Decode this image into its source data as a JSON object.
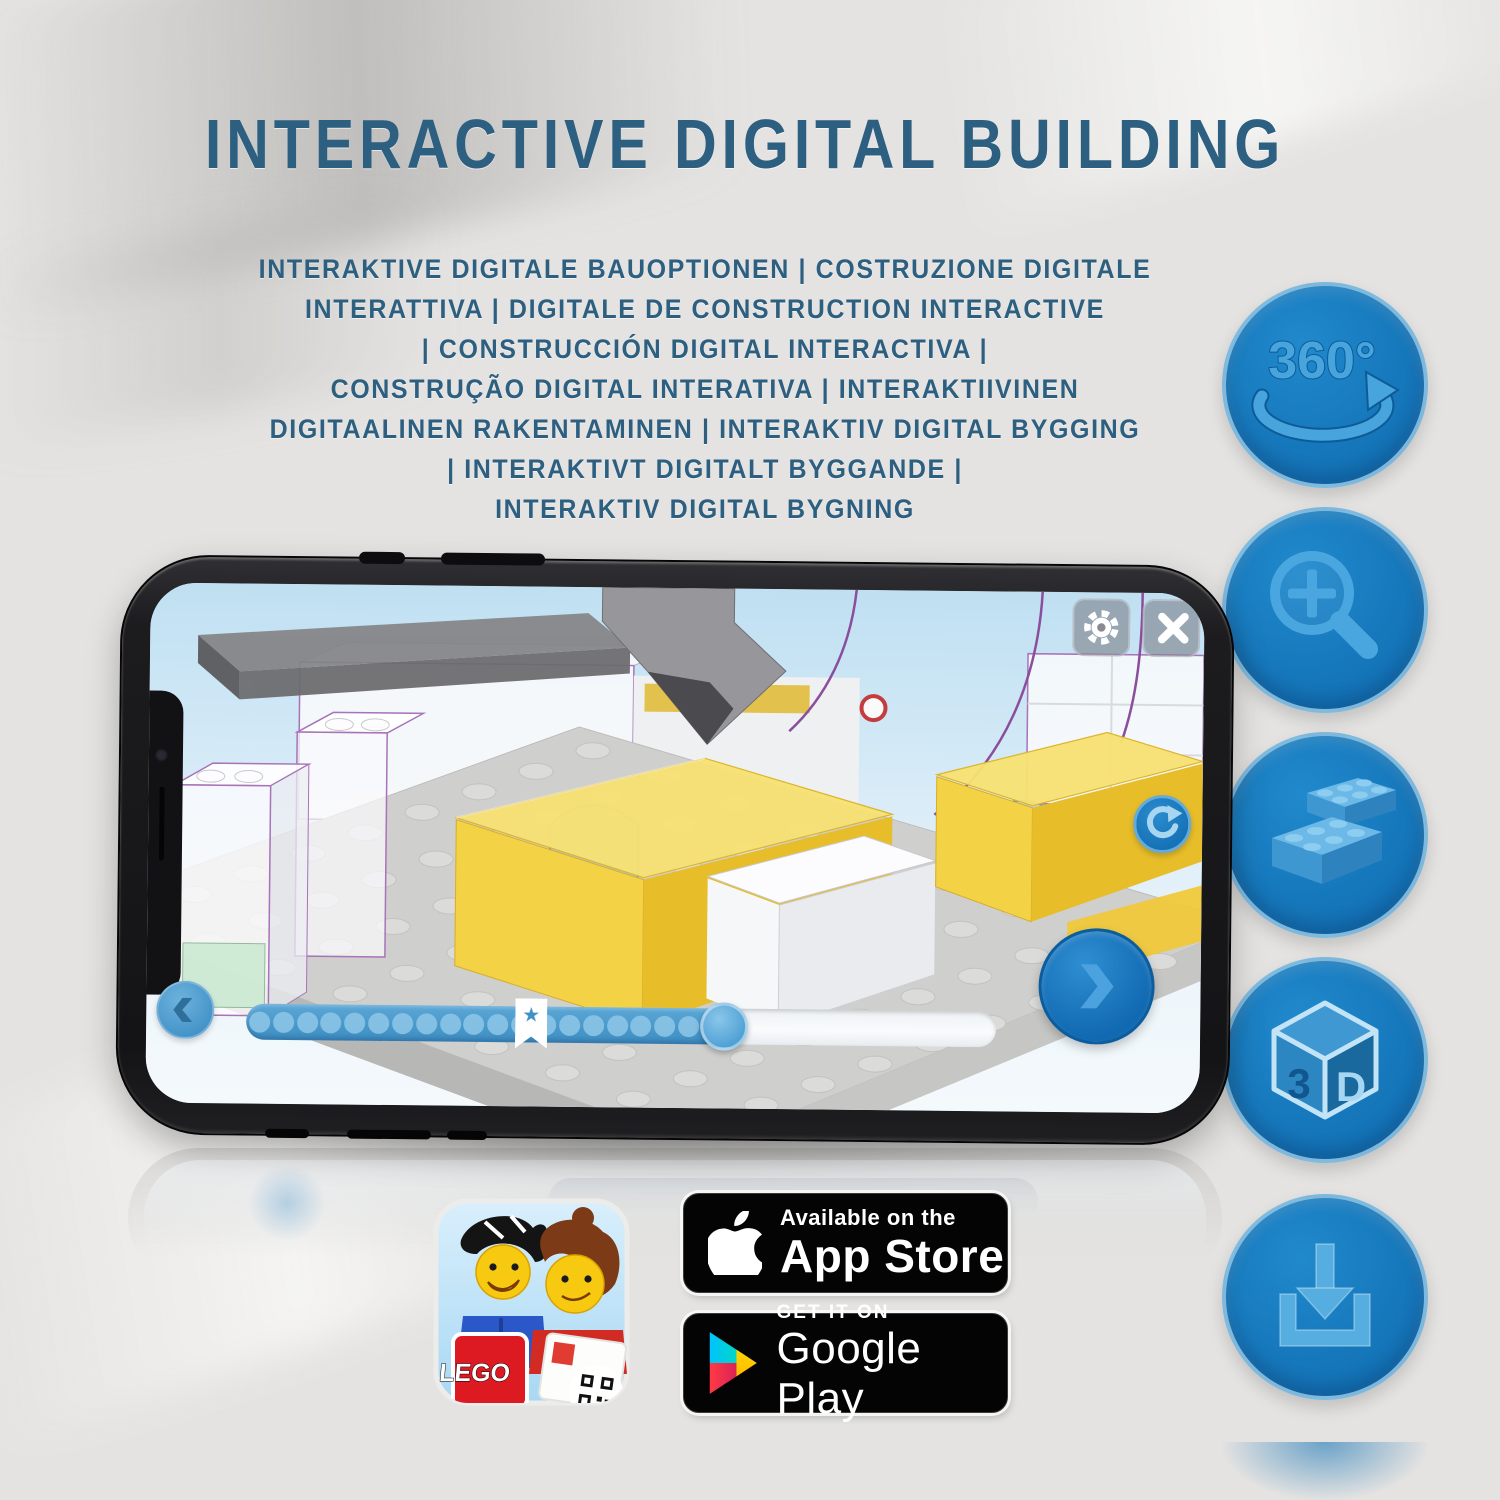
{
  "title": "INTERACTIVE DIGITAL BUILDING",
  "subtitle_lines": [
    "INTERAKTIVE DIGITALE BAUOPTIONEN | COSTRUZIONE DIGITALE",
    "INTERATTIVA | DIGITALE DE CONSTRUCTION INTERACTIVE",
    "| CONSTRUCCIÓN DIGITAL INTERACTIVA |",
    "CONSTRUÇÃO DIGITAL INTERATIVA | INTERAKTIIVINEN",
    "DIGITAALINEN RAKENTAMINEN | INTERAKTIV DIGITAL BYGGING",
    "| INTERAKTIVT DIGITALT BYGGANDE |",
    "INTERAKTIV DIGITAL BYGNING"
  ],
  "features": {
    "rotation_360": {
      "label": "360°"
    },
    "cube_3d": {
      "left_letter": "3",
      "right_letter": "D"
    }
  },
  "phone_app": {
    "progress_percent": 64,
    "progress_dot_count": 20,
    "bookmark_percent": 38,
    "bookmark_star_glyph": "★"
  },
  "store_badges": {
    "app_icon": {
      "logo_text": "LEGO"
    },
    "app_store": {
      "tagline": "Available on the",
      "name": "App Store"
    },
    "google_play": {
      "tagline": "GET IT ON",
      "name": "Google Play"
    }
  },
  "colors": {
    "headline_blue": "#2d5f81",
    "circle_blue": "#1474b8",
    "icon_light_blue": "#4aa6de",
    "lego_red": "#dd1a21",
    "brick_yellow": "#f3d246",
    "outline_purple": "#a873b8",
    "badge_black": "#040404"
  }
}
